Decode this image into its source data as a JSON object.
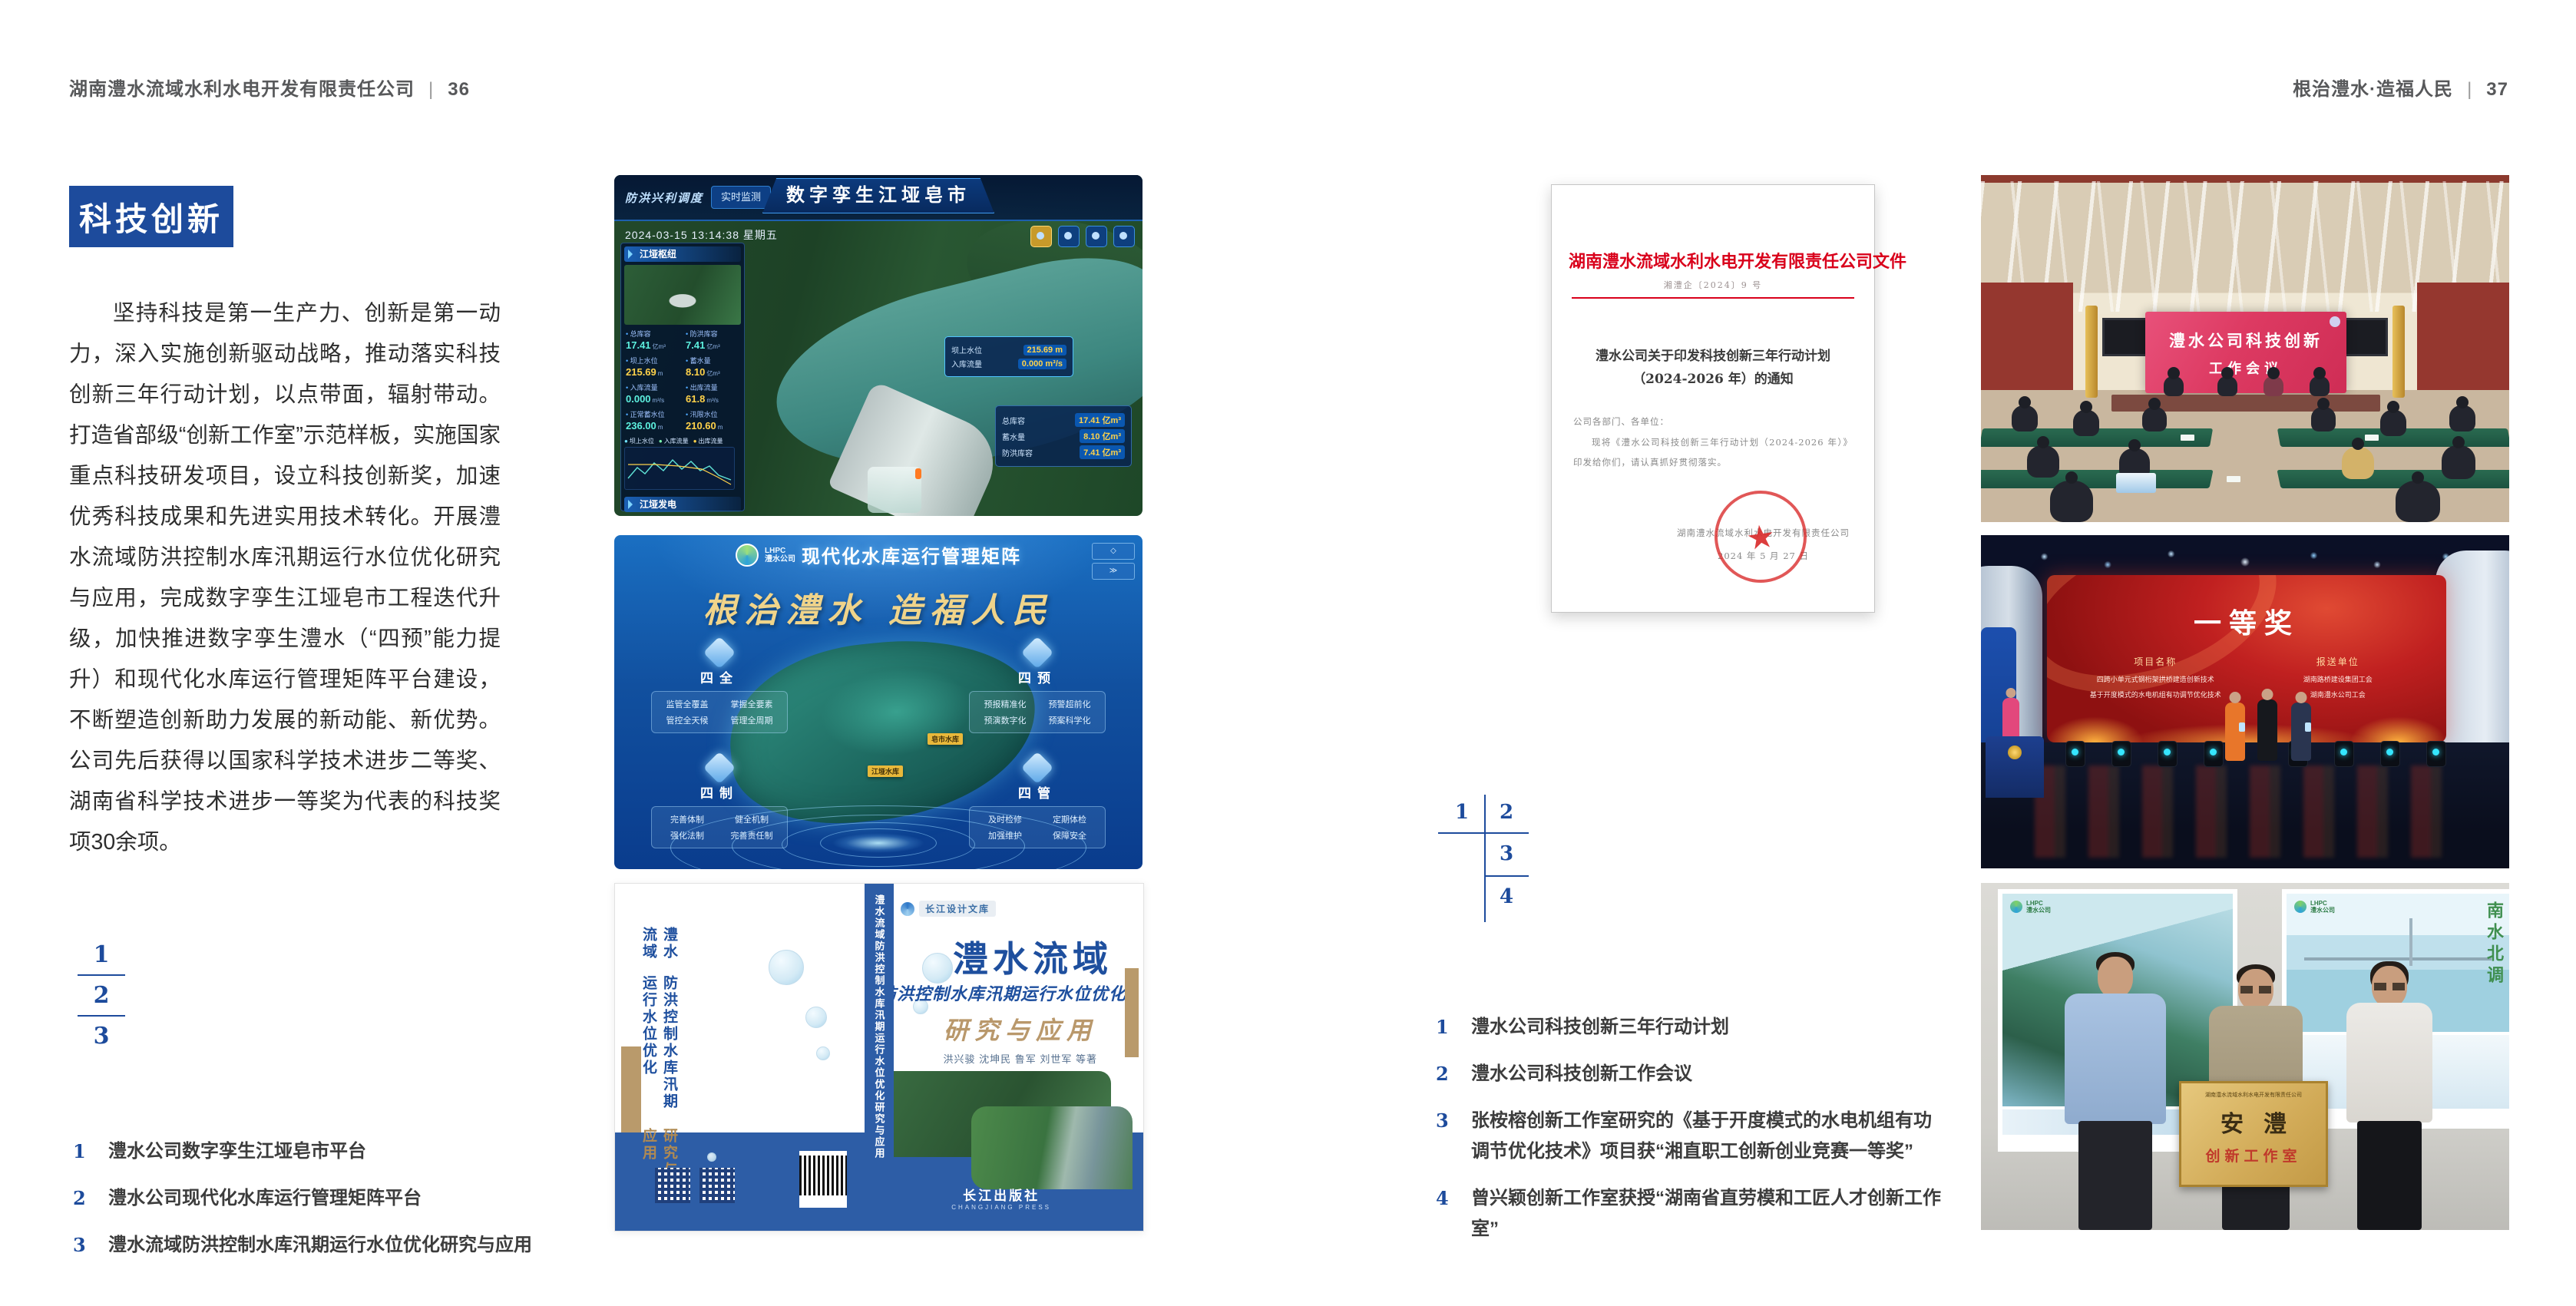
{
  "accent": {
    "blue": "#1d4b9c",
    "red": "#d9001b",
    "gold": "#b9986b"
  },
  "left_page": {
    "header": {
      "company": "湖南澧水流域水利水电开发有限责任公司",
      "divider": "|",
      "page_no": "36"
    },
    "badge": "科技创新",
    "body_text": "坚持科技是第一生产力、创新是第一动力，深入实施创新驱动战略，推动落实科技创新三年行动计划，以点带面，辐射带动。打造省部级“创新工作室”示范样板，实施国家重点科技研发项目，设立科技创新奖，加速优秀科技成果和先进实用技术转化。开展澧水流域防洪控制水库汛期运行水位优化研究与应用，完成数字孪生江垭皂市工程迭代升级，加快推进数字孪生澧水（“四预”能力提升）和现代化水库运行管理矩阵平台建设，不断塑造创新助力发展的新动能、新优势。公司先后获得以国家科学技术进步二等奖、湖南省科学技术进步一等奖为代表的科技奖项30余项。",
    "figure_index": [
      "1",
      "2",
      "3"
    ],
    "captions": [
      {
        "no": "1",
        "text": "澧水公司数字孪生江垭皂市平台"
      },
      {
        "no": "2",
        "text": "澧水公司现代化水库运行管理矩阵平台"
      },
      {
        "no": "3",
        "text": "澧水流域防洪控制水库汛期运行水位优化研究与应用"
      }
    ]
  },
  "right_page": {
    "header": {
      "slogan": "根治澧水·造福人民",
      "divider": "|",
      "page_no": "37"
    },
    "figure_index": [
      "1",
      "2",
      "3",
      "4"
    ],
    "captions": [
      {
        "no": "1",
        "text": "澧水公司科技创新三年行动计划"
      },
      {
        "no": "2",
        "text": "澧水公司科技创新工作会议"
      },
      {
        "no": "3",
        "text": "张桉榕创新工作室研究的《基于开度模式的水电机组有功调节优化技术》项目获“湘直职工创新创业竞赛一等奖”"
      },
      {
        "no": "4",
        "text": "曾兴颖创新工作室获授“湖南省直劳模和工匠人才创新工作室”"
      }
    ]
  },
  "digital_twin": {
    "corner_label": "防洪兴利调度",
    "tabs_left": [
      "实时监测",
      "洪水预报",
      "防汛预警"
    ],
    "title": "数字孪生江垭皂市",
    "tabs_right": [
      "方案预演",
      "预案生成",
      "调度执行",
      "工程导览"
    ],
    "timestamp": "2024-03-15 13:14:38 星期五",
    "panel1_title": "江垭枢纽",
    "stats": [
      {
        "label": "总库容",
        "value": "17.41",
        "unit": "亿m³"
      },
      {
        "label": "防洪库容",
        "value": "7.41",
        "unit": "亿m³"
      },
      {
        "label": "坝上水位",
        "value": "215.69",
        "unit": "m"
      },
      {
        "label": "蓄水量",
        "value": "8.10",
        "ununit": "",
        "unit": "亿m³"
      },
      {
        "label": "入库流量",
        "value": "0.000",
        "unit": "m³/s"
      },
      {
        "label": "出库流量",
        "value": "61.8",
        "unit": "m³/s"
      },
      {
        "label": "正常蓄水位",
        "value": "236.00",
        "unit": "m"
      },
      {
        "label": "汛限水位",
        "value": "210.60",
        "unit": "m"
      }
    ],
    "chart_legend": [
      "坝上水位",
      "入库流量",
      "出库流量"
    ],
    "panel2_title": "江垭发电",
    "gen_stats": [
      {
        "label": "年发电计划",
        "value": "6.3000",
        "unit": "亿度"
      },
      {
        "label": "年累计发电量",
        "value": "2.2907",
        "unit": "亿度"
      },
      {
        "label": "月累计发电量",
        "value": "3359.21",
        "unit": "万度"
      },
      {
        "label": "当前出力",
        "value": "0.00",
        "unit": "MW"
      },
      {
        "label": "发电流量",
        "value": "0.00",
        "unit": "m³/s"
      },
      {
        "label": "弃水流量",
        "value": "0.00",
        "unit": "m³/s"
      }
    ],
    "tooltip": [
      {
        "label": "坝上水位",
        "value": "215.69 m"
      },
      {
        "label": "入库流量",
        "value": "0.000 m³/s"
      }
    ],
    "side_stats": [
      {
        "label": "总库容",
        "value": "17.41 亿m³"
      },
      {
        "label": "蓄水量",
        "value": "8.10 亿m³"
      },
      {
        "label": "防洪库容",
        "value": "7.41 亿m³"
      }
    ]
  },
  "matrix": {
    "brand": "LHPC",
    "brand_sub": "澧水公司",
    "title": "现代化水库运行管理矩阵",
    "slogan": "根治澧水 造福人民",
    "cards": [
      {
        "name": "四全",
        "items": [
          "监管全覆盖",
          "掌握全要素",
          "管控全天候",
          "管理全周期"
        ]
      },
      {
        "name": "四预",
        "items": [
          "预报精准化",
          "预警超前化",
          "预演数字化",
          "预案科学化"
        ]
      },
      {
        "name": "四制",
        "items": [
          "完善体制",
          "健全机制",
          "强化法制",
          "完善责任制"
        ]
      },
      {
        "name": "四管",
        "items": [
          "及时检修",
          "定期体检",
          "加强维护",
          "保障安全"
        ]
      }
    ],
    "map_labels": [
      "江垭水库",
      "皂市水库"
    ]
  },
  "book": {
    "series": "长江设计文库",
    "title_region": "澧水流域",
    "title_sub": "防洪控制水库汛期运行水位优化",
    "title_accent": "研究与应用",
    "authors": "洪兴骏  沈坤民  鲁军  刘世军  等著",
    "spine": "澧水流域防洪控制水库汛期运行水位优化研究与应用",
    "back_title_1": "澧水流域",
    "back_title_2": "防洪控制水库汛期运行水位优化",
    "back_title_3": "研究与应用",
    "publisher": "长江出版社",
    "publisher_en": "CHANGJIANG PRESS"
  },
  "document": {
    "letterhead": "湖南澧水流域水利水电开发有限责任公司文件",
    "doc_no": "湘澧企〔2024〕9 号",
    "title_line1": "澧水公司关于印发科技创新三年行动计划",
    "title_line2": "（2024-2026 年）的通知",
    "salutation": "公司各部门、各单位：",
    "body": "现将《澧水公司科技创新三年行动计划（2024-2026 年）》印发给你们，请认真抓好贯彻落实。",
    "signature": "湖南澧水流域水利水电开发有限责任公司",
    "date": "2024 年 5 月 27 日"
  },
  "meeting": {
    "screen_line1": "澧水公司科技创新",
    "screen_line2": "工作会议"
  },
  "award": {
    "title": "一等奖",
    "col1_header": "项目名称",
    "col1_items": [
      "四跨小单元式钢桁架拱桥建造创新技术",
      "基于开度模式的水电机组有功调节优化技术"
    ],
    "col2_header": "报送单位",
    "col2_items": [
      "湖南路桥建设集团工会",
      "湖南澧水公司工会"
    ]
  },
  "group_photo": {
    "plaque_header": "湖南澧水流域水利水电开发有限责任公司",
    "plaque_title": "安澧",
    "plaque_sub": "创新工作室",
    "poster_caption": "南水北调"
  }
}
